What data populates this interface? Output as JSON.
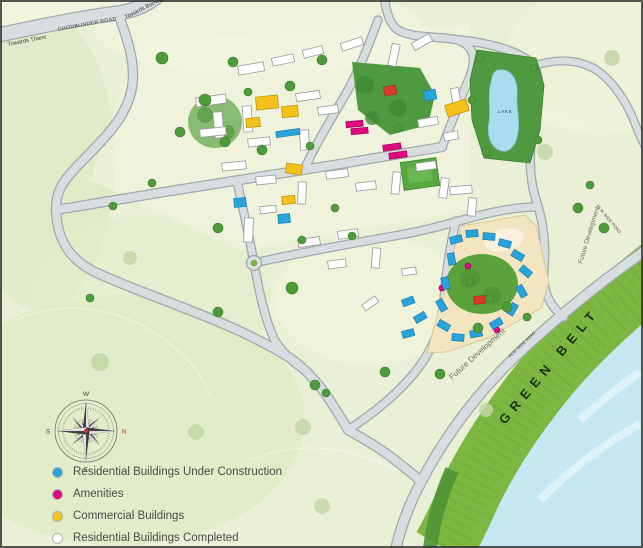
{
  "legend": {
    "items": [
      {
        "label": "Residential Buildings Under Construction",
        "color": "#2AA3DB",
        "outlined": false
      },
      {
        "label": "Amenities",
        "color": "#E0087E",
        "outlined": false
      },
      {
        "label": "Commercial Buildings",
        "color": "#F5C21B",
        "outlined": false
      },
      {
        "label": "Residential Buildings Completed",
        "color": "#FFFFFF",
        "outlined": true
      }
    ],
    "disclaimer": "Plan is not upto the scale"
  },
  "map_labels": {
    "towards_thane": "Towards Thane",
    "ghodbunder_road": "GHODBUNDER ROAD",
    "towards_borivali": "Towards Borivali",
    "green_belt": "GREEN BELT",
    "lake": "LAKE",
    "future_development_south": "Future Development",
    "future_development_east": "Future Development",
    "road_45m": "45 M. WIDE ROAD"
  },
  "compass": {
    "north": "N",
    "east": "E",
    "south": "S",
    "west": "W"
  },
  "colors": {
    "under_construction": "#2AA3DB",
    "amenities": "#E0087E",
    "commercial": "#F5C21B",
    "completed": "#FFFFFF",
    "green_belt": "#7DB742",
    "water": "#C5E8F3",
    "road": "#D8DDDF"
  }
}
